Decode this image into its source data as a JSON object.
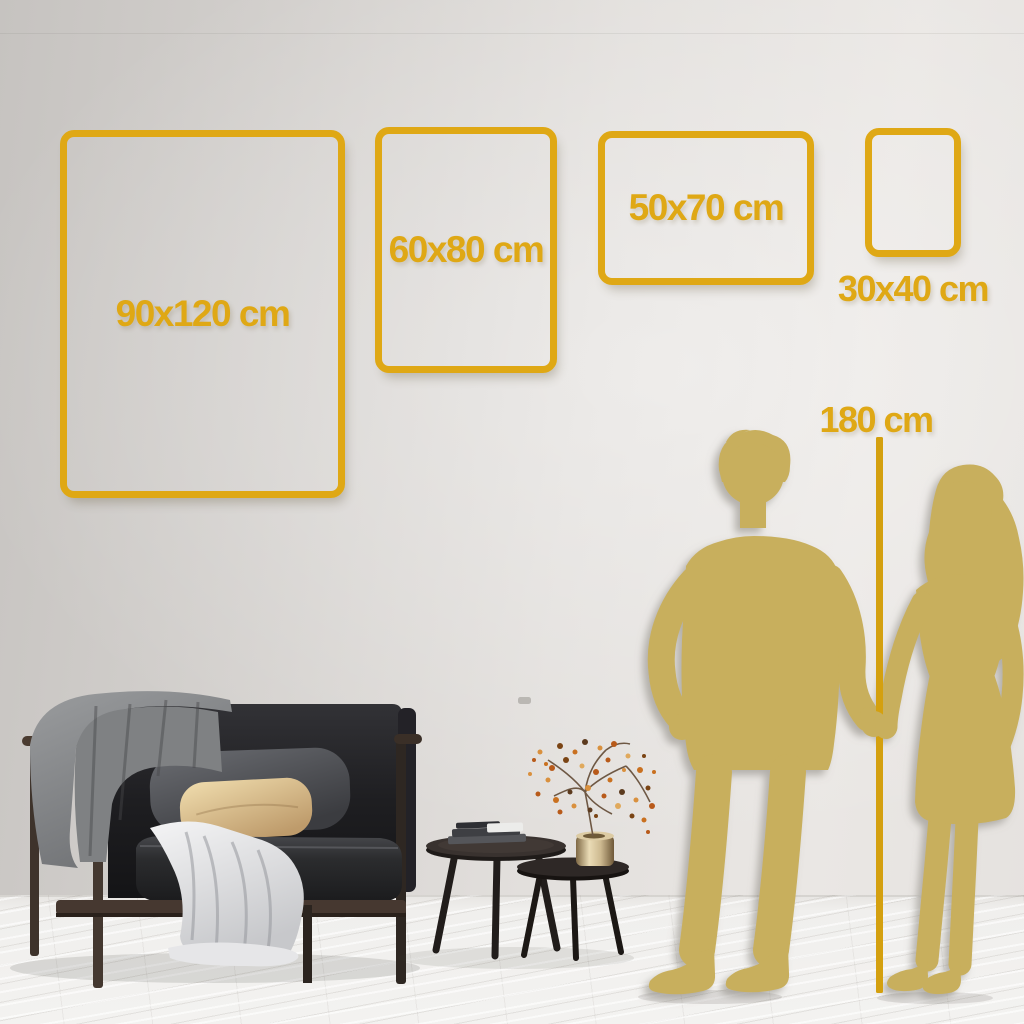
{
  "size_guide": {
    "unit": "cm",
    "options": [
      {
        "label": "90x120 cm",
        "width_cm": 90,
        "height_cm": 120
      },
      {
        "label": "60x80 cm",
        "width_cm": 60,
        "height_cm": 80
      },
      {
        "label": "50x70 cm",
        "width_cm": 50,
        "height_cm": 70
      },
      {
        "label": "30x40 cm",
        "width_cm": 30,
        "height_cm": 40
      }
    ],
    "reference": {
      "label": "180 cm",
      "height_cm": 180
    }
  },
  "colors": {
    "accent_gold": "#DFA815",
    "ruler_gold": "#D4A00F",
    "silhouette_gold": "#C8AF5D",
    "wall": "#E2DFDC",
    "floor": "#F1F0EE"
  },
  "illustrations": [
    "sofa",
    "throw-blanket",
    "white-drape",
    "cushions",
    "nesting-coffee-tables",
    "books",
    "brass-vase",
    "dried-branch",
    "couple-silhouette",
    "height-ruler-line"
  ]
}
